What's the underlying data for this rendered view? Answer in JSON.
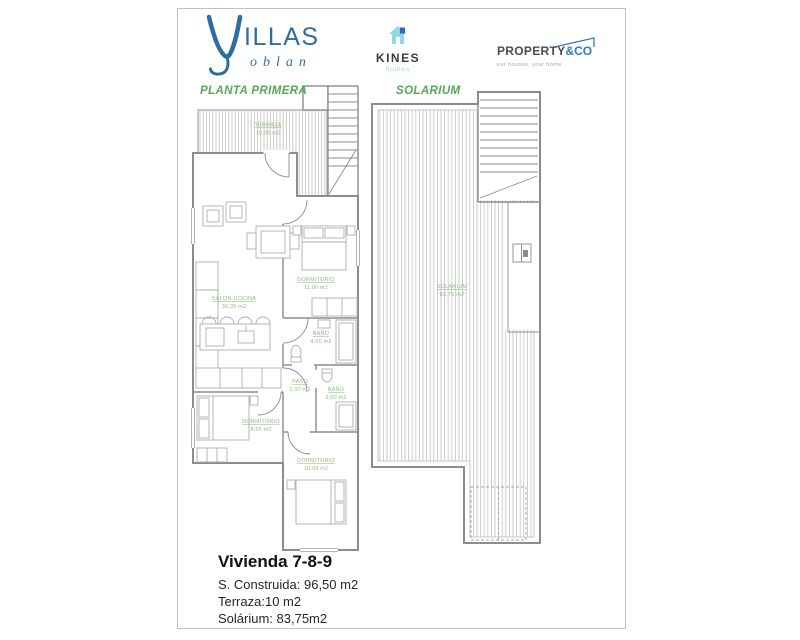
{
  "header": {
    "villas_logo": {
      "title": "ILLAS",
      "subtitle": "oblan"
    },
    "kines_logo": {
      "title": "KINES",
      "subtitle": "homes"
    },
    "property_logo": {
      "title": "PROPERTY",
      "suffix": "&CO",
      "tagline": "our houses, your home"
    }
  },
  "plans": {
    "planta_primera": {
      "label": "PLANTA PRIMERA",
      "rooms": {
        "terraza": {
          "name": "TERRAZA",
          "area": "10,00 m2"
        },
        "salon_cocina": {
          "name": "SALON-COCINA",
          "area": "30,35 m2"
        },
        "dormitorio_1": {
          "name": "DORMITORIO",
          "area": "11,00 m2"
        },
        "bano_1": {
          "name": "BAÑO",
          "area": "4,00 m2"
        },
        "paso": {
          "name": "PASO",
          "area": "2,00 m2"
        },
        "bano_2": {
          "name": "BAÑO",
          "area": "3,00 m2"
        },
        "dormitorio_2": {
          "name": "DORMITORIO",
          "area": "8,65 m2"
        },
        "dormitorio_3": {
          "name": "DORMITORIO",
          "area": "10,99 m2"
        }
      }
    },
    "solarium": {
      "label": "SOLARIUM",
      "rooms": {
        "solarium": {
          "name": "SOLARIUM",
          "area": "83,75 m2"
        }
      }
    }
  },
  "summary": {
    "title": "Vivienda 7-8-9",
    "built_area": "S. Construida: 96,50 m2",
    "terrace": "Terraza:10 m2",
    "solarium": "Solárium: 83,75m2"
  },
  "colors": {
    "brand_blue": "#2d6e9e",
    "kines_light_blue": "#8fd8e8",
    "property_blue": "#2e7cc3",
    "plan_title_green": "#55a855",
    "room_label_green": "#8fbb84",
    "wall_gray": "#8c8c8c"
  }
}
